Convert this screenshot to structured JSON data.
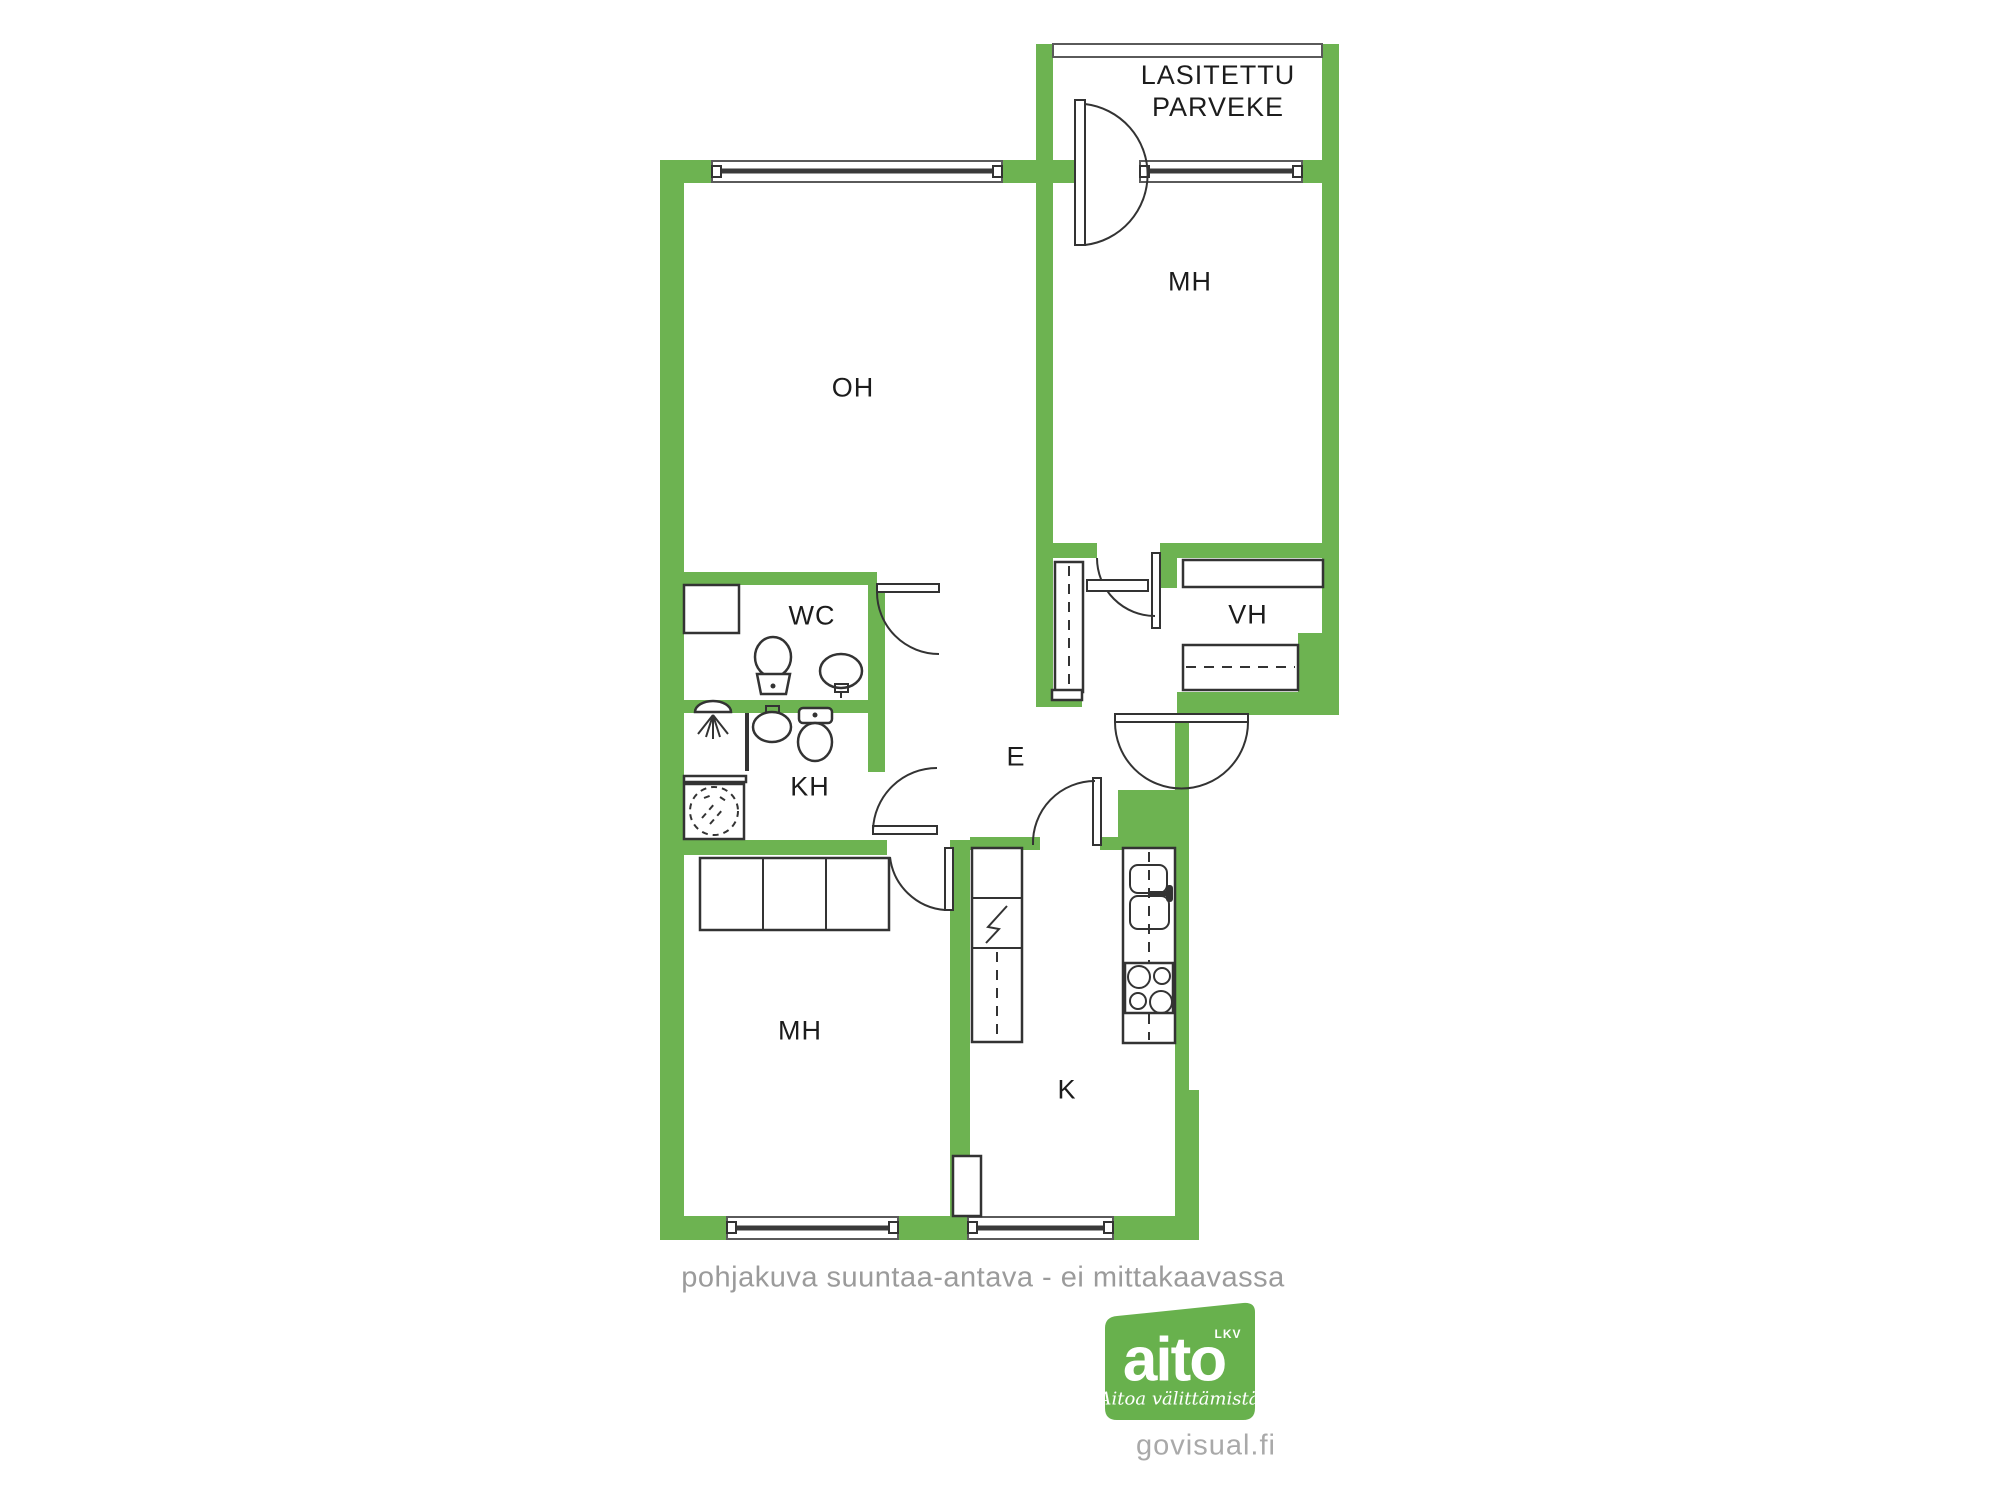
{
  "colors": {
    "wall_green": "#6db351",
    "line_dark": "#333333",
    "text_dark": "#1c1c1c",
    "muted_gray": "#9b9b9b",
    "logo_green": "#68b14d",
    "watermark_gray": "#a9a9a9"
  },
  "floor_plan": {
    "balcony_label_line1": "LASITETTU",
    "balcony_label_line2": "PARVEKE",
    "rooms": {
      "living": "OH",
      "bedroom_top": "MH",
      "wc": "WC",
      "bathroom": "KH",
      "closet": "VH",
      "entry": "E",
      "bedroom_bottom": "MH",
      "kitchen": "K"
    }
  },
  "footer": {
    "disclaimer": "pohjakuva suuntaa-antava - ei mittakaavassa",
    "watermark": "govisual.fi"
  },
  "logo": {
    "brand": "aito",
    "suffix": "LKV",
    "tagline": "Aitoa välittämistä"
  }
}
